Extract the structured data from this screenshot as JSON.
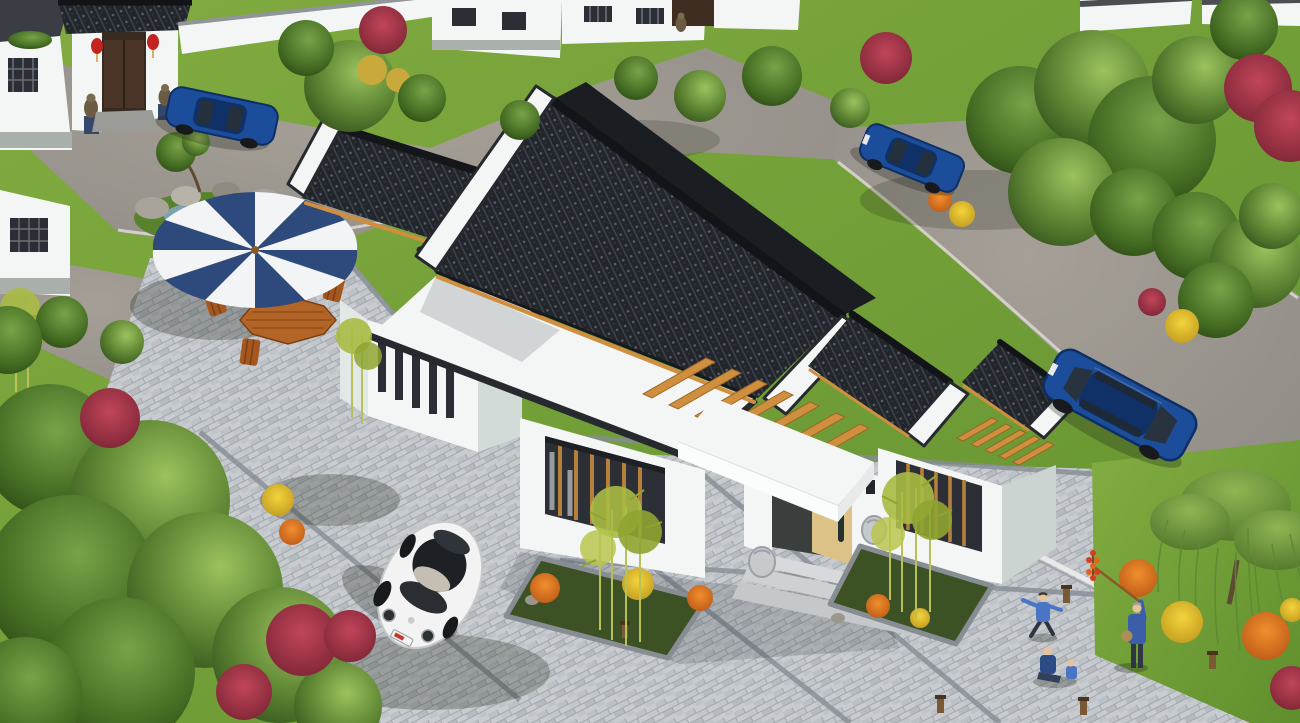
{
  "meta": {
    "scene_type": "3d-architectural-rendering",
    "view": "aerial-oblique",
    "subject": "modern chinese courtyard residence with landscaped grounds"
  },
  "palette": {
    "grass_base": "#7aa43c",
    "grass_dark": "#527d28",
    "road": "#98938b",
    "paver": "#c8ccd0",
    "paver_border": "#868c93",
    "roof_tile": "#23262b",
    "roof_ridge": "#14161a",
    "wall_white": "#f4f6f6",
    "wall_shade": "#d3dbd8",
    "coping": "#26292e",
    "wood_beam": "#cf8f3f",
    "wood_door": "#ddc287",
    "window_dark": "#2b2f35",
    "window_slat": "#b5803c",
    "water": "#7fa3ae",
    "rock": "#a8a499",
    "foliage": "#5c8432",
    "foliage_dark": "#2f4b1a",
    "bamboo": "#aabb45",
    "flower_red": "#a93448",
    "flower_orange": "#d2611d",
    "flower_yellow": "#e5c22f",
    "car_blue": "#1c4d9a",
    "car_white": "#f2f3f2",
    "umbrella_blue": "#2e4a7d",
    "umbrella_white": "#f2f4f6",
    "people_blue": "#3a5fa8",
    "people_blue_light": "#4a74c4",
    "lantern_red": "#c3241f",
    "stone_lion": "#6b5b43",
    "step_stone": "#d7dadc"
  },
  "scene": {
    "residence": {
      "style": "single-storey white stucco courtyard house",
      "roofs": [
        "charcoal clay-tile gabled roofs with black ridge caps",
        "white flat roofs edged with dark parapet coping",
        "white gable (horse-head) walls with dark coping"
      ],
      "features": [
        "timber pergola beams over two inner courtyards",
        "recessed entry porch with pale timber door and flat canopy",
        "stone drum flanks beside entry steps",
        "vertical slot windows on left wing",
        "timber-slat picture windows",
        "stone-edged planting beds with bamboo and flowers"
      ]
    },
    "vehicles": [
      {
        "name": "white-beetle",
        "type": "compact car",
        "color": "white",
        "location": "front paver driveway, lower left"
      },
      {
        "name": "blue-sedan-parked",
        "type": "sedan",
        "color": "dark blue",
        "location": "right-hand road beside plaza"
      },
      {
        "name": "blue-sedan-street",
        "type": "sedan",
        "color": "blue",
        "location": "upper-right road"
      },
      {
        "name": "blue-sedan-gate",
        "type": "sedan",
        "color": "blue",
        "location": "upper-left lane by neighbour gate"
      }
    ],
    "people": [
      {
        "name": "candy-vendor",
        "desc": "man in blue raising a pole of candied hawthorn skewers",
        "location": "lower-right plaza"
      },
      {
        "name": "running-child",
        "desc": "child in blue playing",
        "location": "lower-right plaza"
      },
      {
        "name": "seated-adult-and-child",
        "desc": "two figures seated on the paving",
        "location": "lower-right plaza"
      }
    ],
    "site": {
      "paving": [
        "grey brick pavers with darker border banding",
        "asphalt lanes with light stone curbs"
      ],
      "landscape": [
        "large green shade trees",
        "weeping willow",
        "bamboo clumps",
        "red, orange and yellow flowering shrubs",
        "rock garden with small pond",
        "lawns"
      ],
      "furniture": [
        "blue-and-white striped parasol",
        "octagonal timber table",
        "four timber chairs",
        "timber bollard lights"
      ]
    },
    "neighborhood": [
      "traditional gatehouse with dark tile roof",
      "red lanterns",
      "stone guardian lions",
      "white perimeter walls with lattice windows",
      "rows of white courtyard houses"
    ]
  }
}
